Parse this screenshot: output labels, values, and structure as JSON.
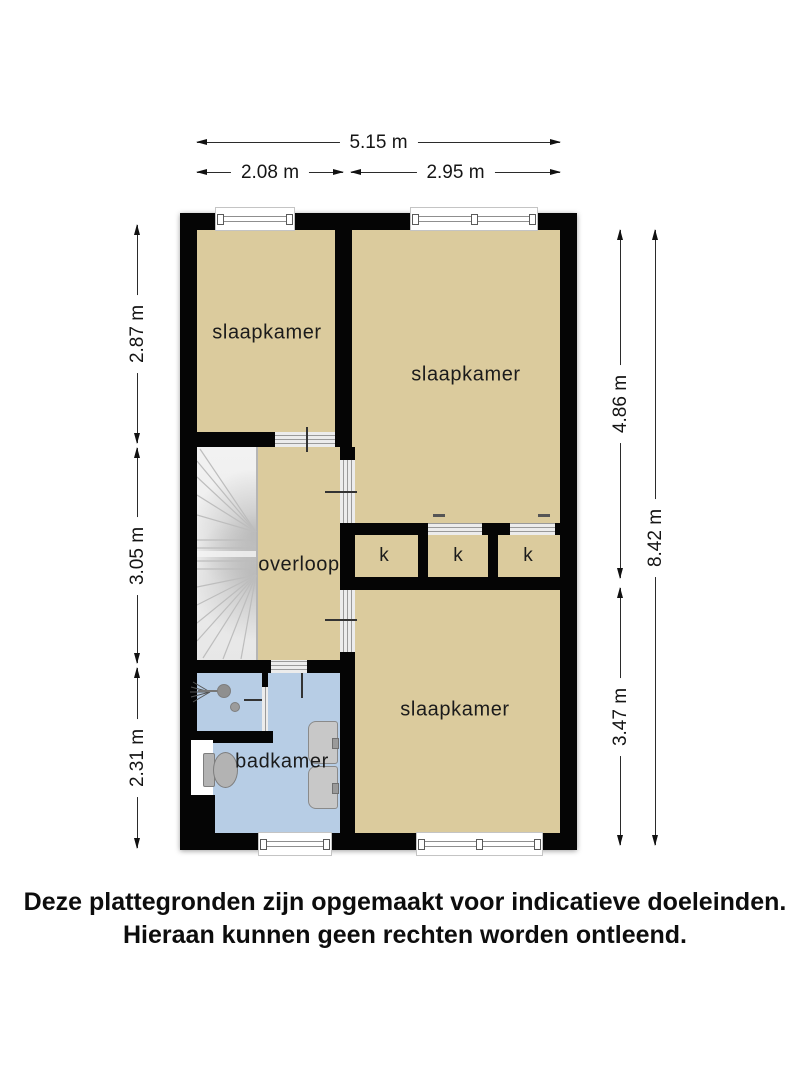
{
  "rooms": {
    "slaapkamer_tl": "slaapkamer",
    "slaapkamer_tr": "slaapkamer",
    "slaapkamer_bottom": "slaapkamer",
    "overloop": "overloop",
    "badkamer": "badkamer",
    "kast_1": "k",
    "kast_2": "k",
    "kast_3": "k"
  },
  "dimensions": {
    "width_total": "5.15 m",
    "width_left": "2.08 m",
    "width_right": "2.95 m",
    "height_top_left": "2.87 m",
    "height_mid_left": "3.05 m",
    "height_bottom_left": "2.31 m",
    "height_top_right": "4.86 m",
    "height_bottom_right": "3.47 m",
    "height_total": "8.42 m"
  },
  "disclaimer": {
    "line1": "Deze plattegronden zijn opgemaakt voor indicatieve doeleinden.",
    "line2": "Hieraan kunnen geen rechten worden ontleend."
  },
  "colors": {
    "floor": "#dbcb9d",
    "bathroom_floor": "#b7cde5",
    "wall": "#050505",
    "stairs": "#ededed"
  }
}
